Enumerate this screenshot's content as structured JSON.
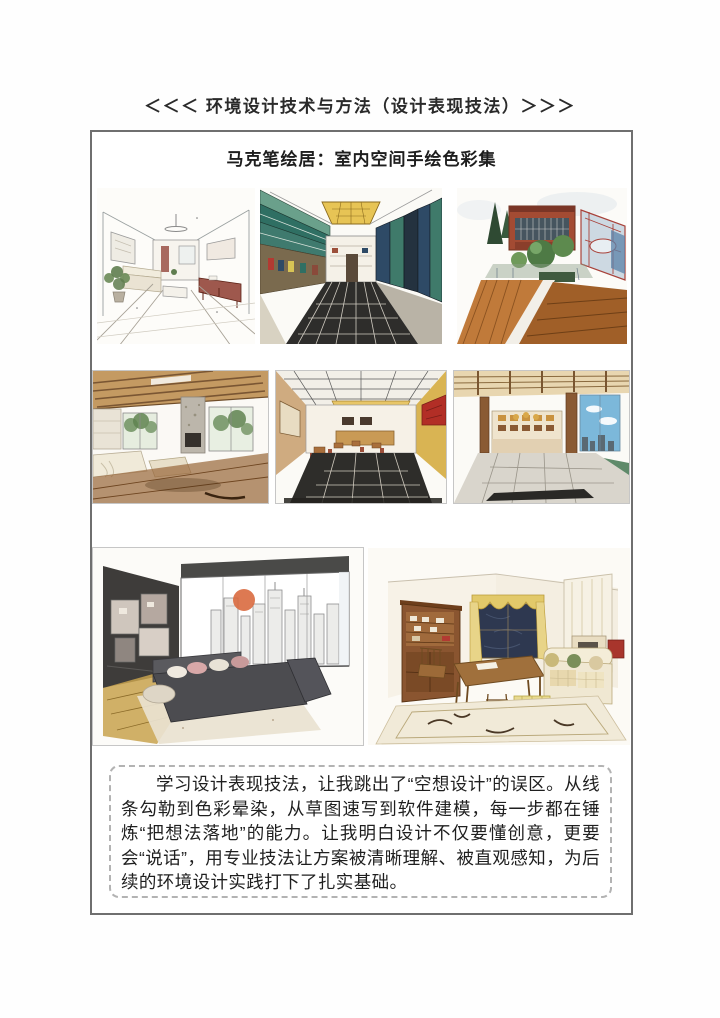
{
  "page": {
    "header_title": "＜＜＜ 环境设计技术与方法（设计表现技法）＞＞＞"
  },
  "board": {
    "title": "马克笔绘居：室内空间手绘色彩集",
    "reflection": "学习设计表现技法，让我跳出了“空想设计”的误区。从线条勾勒到色彩晕染，从草图速写到软件建模，每一步都在锤炼“把想法落地”的能力。让我明白设计不仅要懂创意，更要会“说话”，用专业技法让方案被清晰理解、被直观感知，为后续的环境设计实践打下了扎实基础。"
  },
  "gallery": {
    "items": [
      {
        "label": "客厅一点透视线稿手绘"
      },
      {
        "label": "书店室内马克笔手绘"
      },
      {
        "label": "建筑庭院木平台马克笔手绘"
      },
      {
        "label": "木梁开放式客厅厨房手绘"
      },
      {
        "label": "餐厅室内马克笔手绘"
      },
      {
        "label": "大堂休闲区马克笔手绘"
      },
      {
        "label": "城市窗景客厅马克笔手绘"
      },
      {
        "label": "乡村风格客厅马克笔手绘"
      }
    ]
  },
  "style": {
    "frame_color": "#6f6f6f",
    "dash_color": "#b3b3b3",
    "ink_color": "#1f1f1f"
  }
}
